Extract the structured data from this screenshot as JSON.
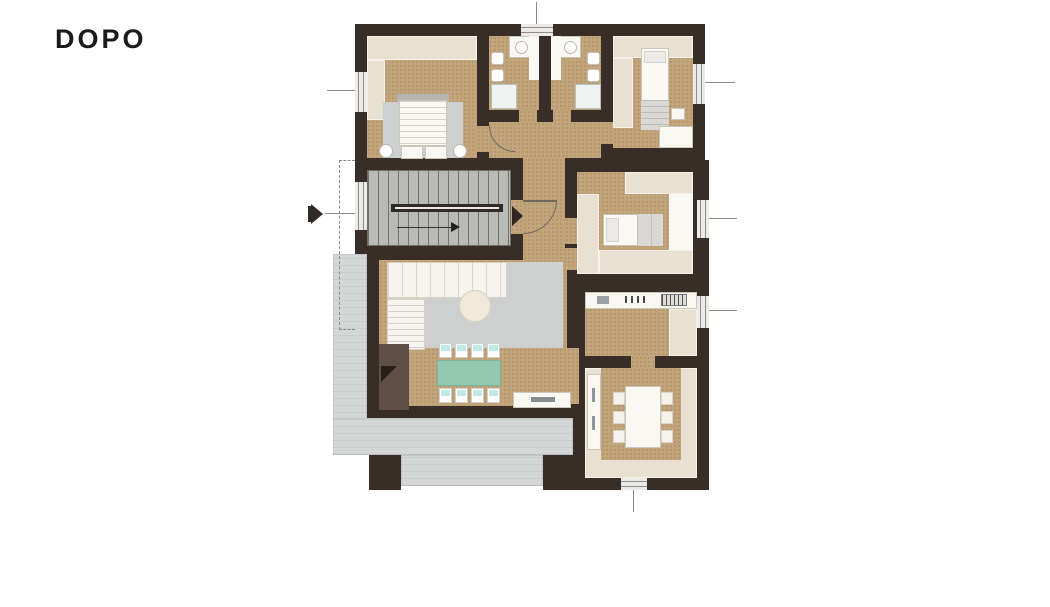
{
  "title": {
    "label": "DOPO"
  },
  "colors": {
    "bg": "#ffffff",
    "title_color": "#1b1b1b",
    "wall": "#392d28",
    "floor": "#c3a57b",
    "floor_speckle": "#b2946c",
    "wardrobe": "#e8e1d1",
    "white": "#faf8f3",
    "terrace": "#d4d7d6",
    "stair": "#b9bab6",
    "rug": "#cdd0ce",
    "teal_table": "#92c8ad",
    "chair_accent": "#bfe9e6",
    "brown_unit": "#5f4e45",
    "line": "#6f675e"
  },
  "plan": {
    "kind": "apartment-floor-plan",
    "stage": "after-renovation",
    "rooms": [
      {
        "name": "bedroom-main",
        "furniture": [
          "double-bed",
          "wardrobe",
          "rug",
          "nightstands"
        ]
      },
      {
        "name": "bathroom-1",
        "furniture": [
          "sink",
          "toilet",
          "bidet",
          "shower"
        ]
      },
      {
        "name": "bathroom-2",
        "furniture": [
          "sink",
          "toilet",
          "bidet",
          "shower"
        ]
      },
      {
        "name": "bedroom-2",
        "furniture": [
          "single-bed",
          "wardrobe",
          "desk"
        ]
      },
      {
        "name": "bedroom-3",
        "furniture": [
          "single-bed",
          "wardrobe"
        ]
      },
      {
        "name": "hallway",
        "furniture": []
      },
      {
        "name": "staircase",
        "furniture": [
          "u-shaped-stairs",
          "entry-door"
        ]
      },
      {
        "name": "living-room",
        "furniture": [
          "corner-sofa",
          "rug",
          "round-coffee-table",
          "dining-table-8-chairs",
          "fireplace-unit",
          "sideboard"
        ]
      },
      {
        "name": "kitchen",
        "furniture": [
          "counter-with-sink-and-cooktop"
        ]
      },
      {
        "name": "dining-room",
        "furniture": [
          "table-6-chairs",
          "side-counter"
        ]
      },
      {
        "name": "terrace",
        "furniture": [
          "pillars"
        ]
      }
    ]
  }
}
